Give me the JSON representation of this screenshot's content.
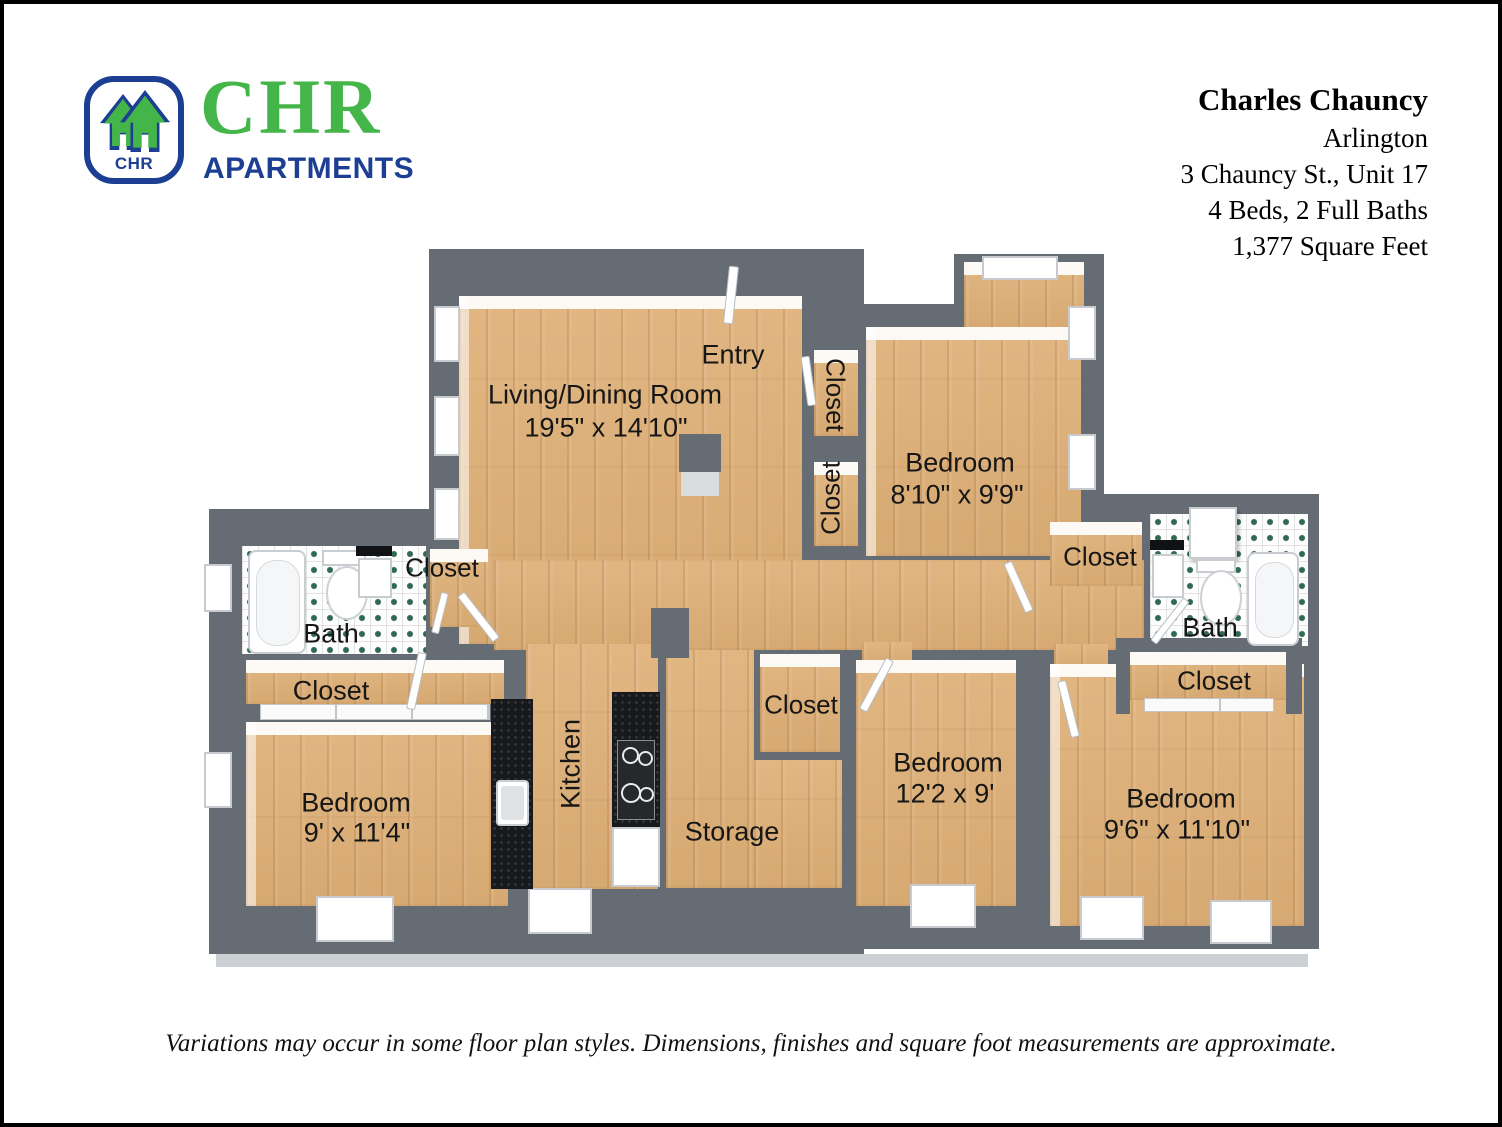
{
  "header": {
    "logo": {
      "monogram": "CHR",
      "brand": "CHR",
      "brand_sub": "APARTMENTS"
    },
    "listing": {
      "title": "Charles Chauncy",
      "city": "Arlington",
      "address": "3 Chauncy St., Unit 17",
      "beds_baths": "4 Beds, 2 Full Baths",
      "area": "1,377 Square Feet"
    }
  },
  "floorplan": {
    "labels": {
      "entry": {
        "text": "Entry"
      },
      "living": {
        "name": "Living/Dining Room",
        "dims": "19'5\" x 14'10\""
      },
      "closet_entry_top": {
        "text": "Closet"
      },
      "closet_entry_bottom": {
        "text": "Closet"
      },
      "bedroom_top_right": {
        "name": "Bedroom",
        "dims": "8'10\" x 9'9\""
      },
      "bath_left": {
        "text": "Bath"
      },
      "closet_bath_left": {
        "text": "Closet"
      },
      "closet_left": {
        "text": "Closet"
      },
      "bedroom_bottom_left": {
        "name": "Bedroom",
        "dims": "9' x 11'4\""
      },
      "kitchen": {
        "text": "Kitchen"
      },
      "storage": {
        "text": "Storage"
      },
      "closet_middle": {
        "text": "Closet"
      },
      "bedroom_middle": {
        "name": "Bedroom",
        "dims": "12'2 x 9'"
      },
      "closet_right_top": {
        "text": "Closet"
      },
      "bath_right": {
        "text": "Bath"
      },
      "closet_right": {
        "text": "Closet"
      },
      "bedroom_bottom_right": {
        "name": "Bedroom",
        "dims": "9'6\" x 11'10\""
      }
    }
  },
  "footer": {
    "disclaimer": "Variations may occur in some floor plan styles. Dimensions, finishes and square foot measurements are approximate."
  },
  "colors": {
    "brand_green": "#44b649",
    "brand_blue": "#1c3f94",
    "wall_gray": "#666c74",
    "floor_wood": "#dfb077",
    "tile_dot_green": "#2e6b52",
    "counter_black": "#17191c"
  }
}
